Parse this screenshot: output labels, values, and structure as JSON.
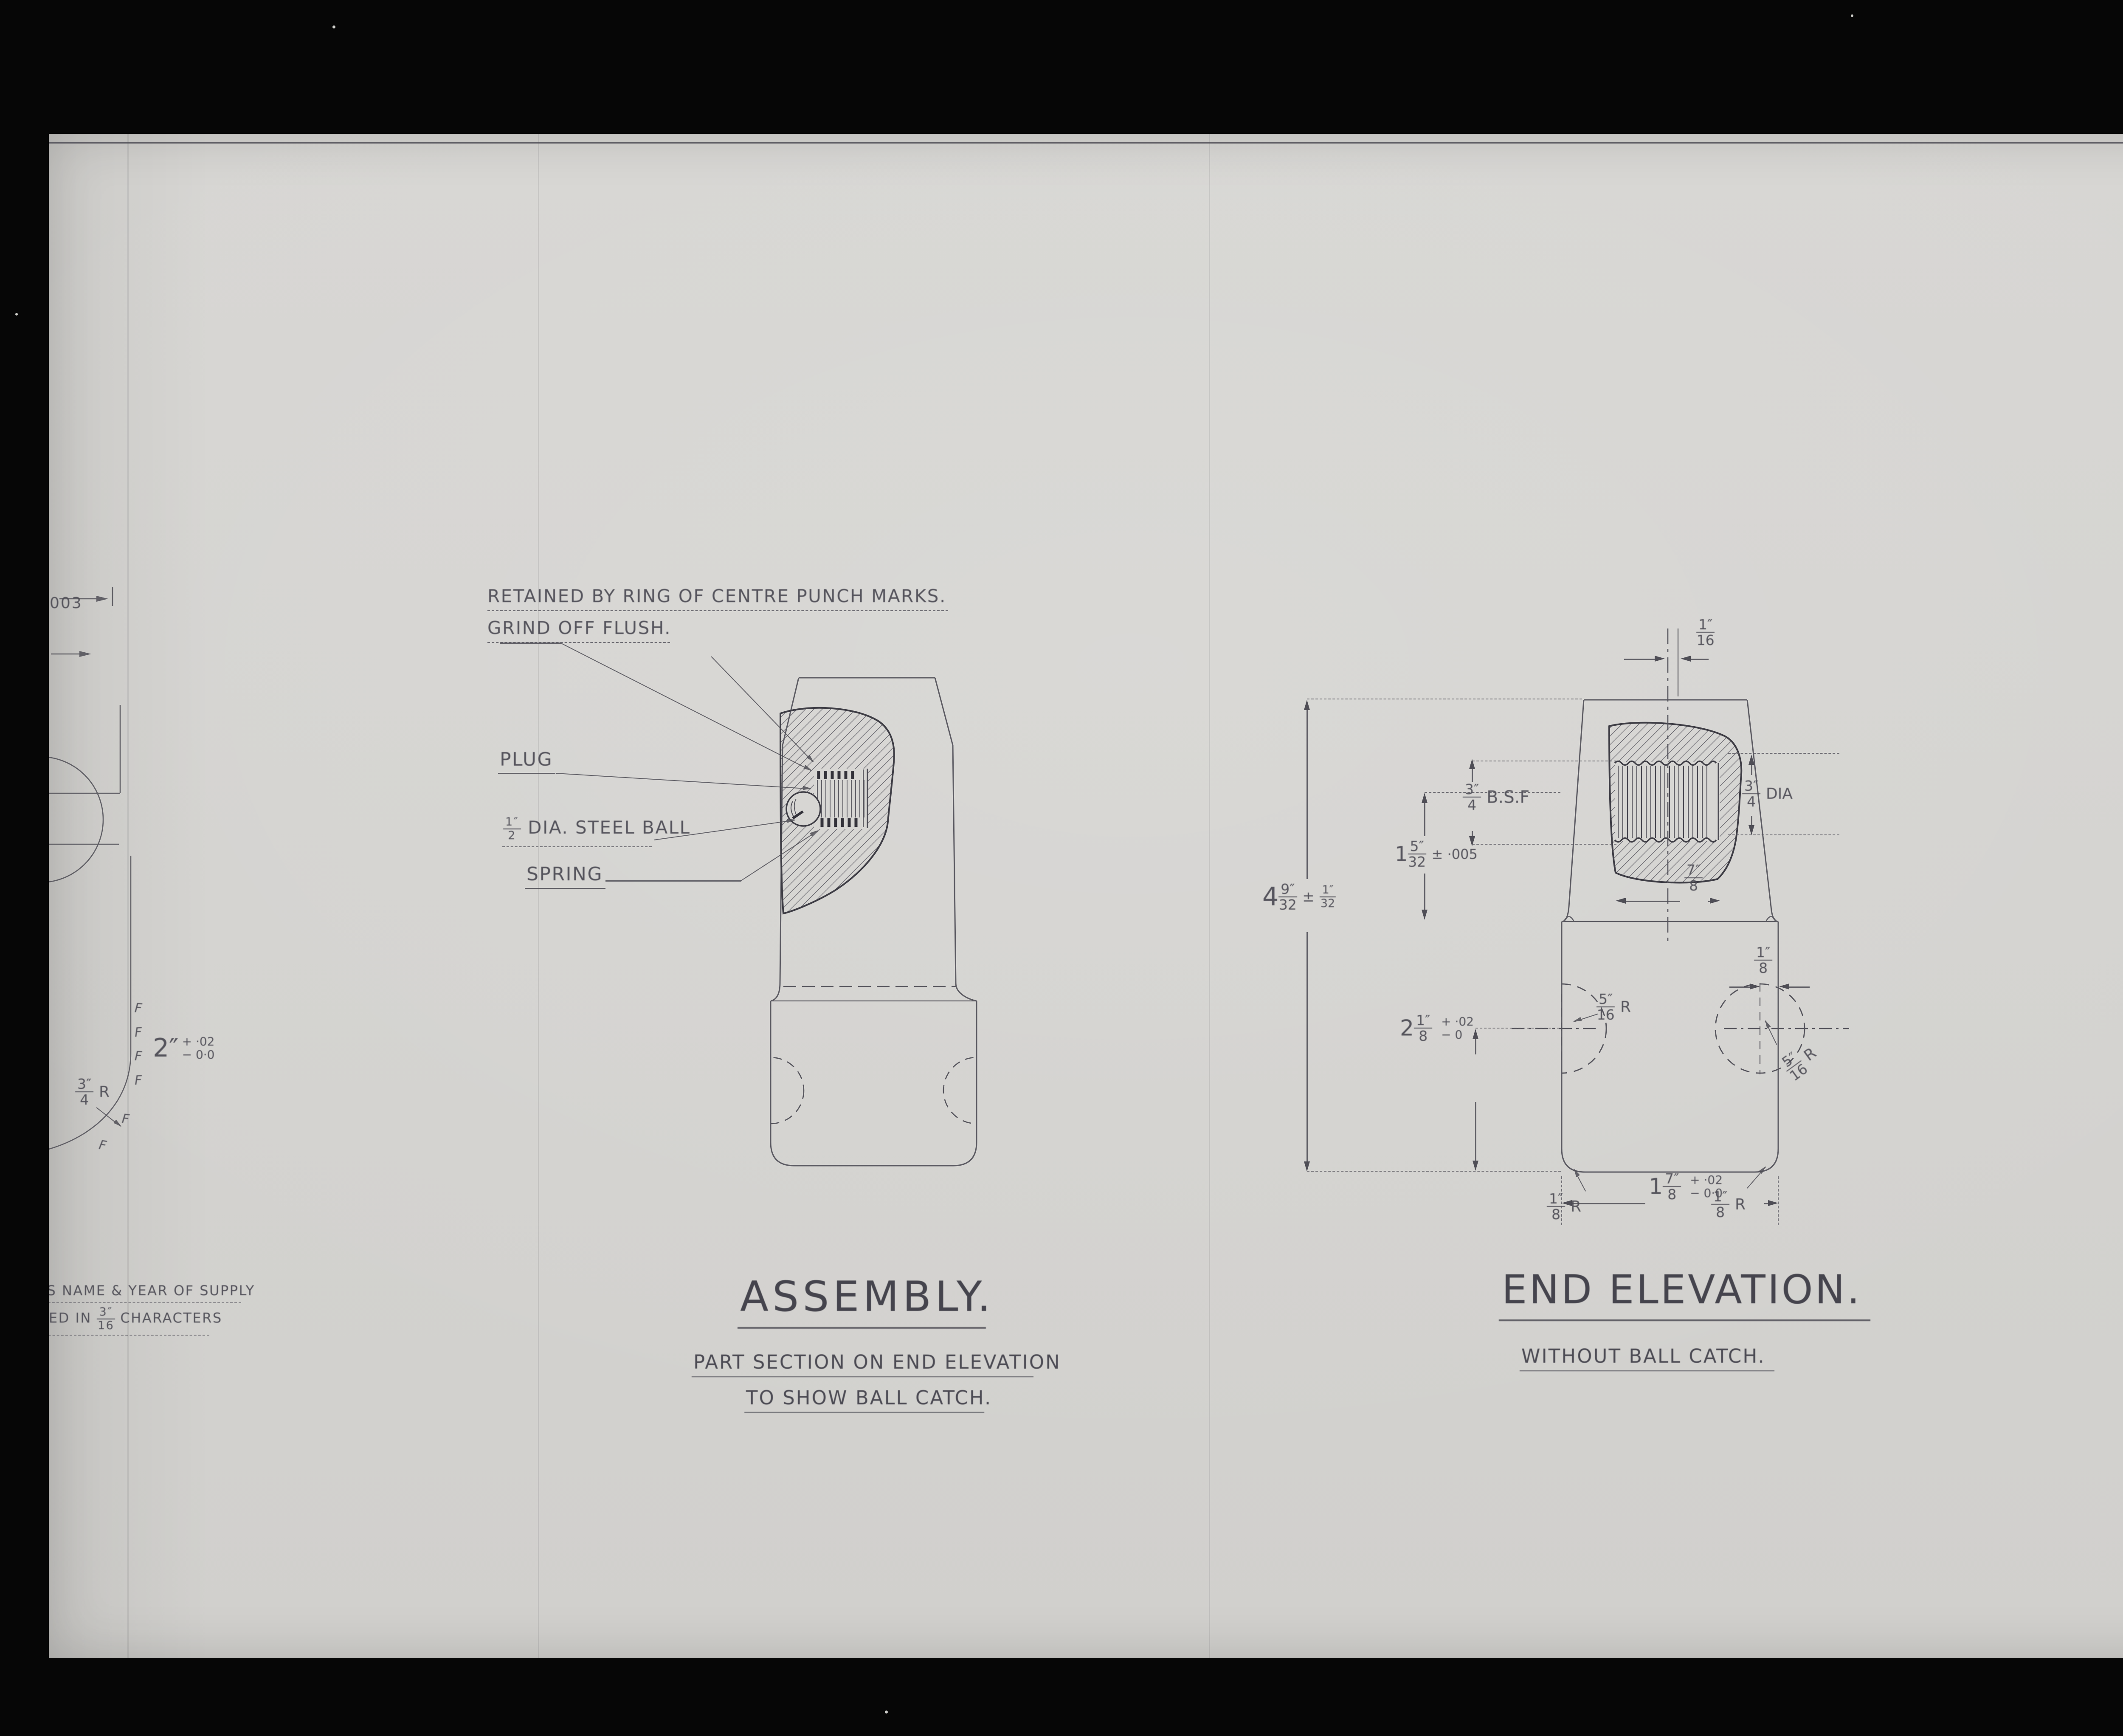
{
  "palette": {
    "paper": "#d6d5d2",
    "line": "#4f4e56",
    "stamp_ink": "#1a1a1a"
  },
  "corner_note": {
    "l1": "GIVEN A",
    "l2": "NEW. I.R.E.S Nº.",
    "l3": "OLD Nº WAS",
    "l4": "I.R.E.S/M/3940",
    "l4_sup": "c",
    "l5": "/XII/10."
  },
  "left_view": {
    "dim003": "003",
    "dim2": {
      "whole": "2″",
      "plus": "+ ·02",
      "minus": "− 0·0"
    },
    "radius": {
      "num": "3″",
      "den": "4",
      "suffix": "R"
    },
    "finish": "F",
    "note1": "ERS NAME & YEAR OF SUPPLY",
    "note2_pre": "MPED IN",
    "note2_num": "3″",
    "note2_den": "16",
    "note2_post": "CHARACTERS"
  },
  "assembly": {
    "note1": "RETAINED BY RING OF CENTRE PUNCH MARKS.",
    "note2": "GRIND OFF FLUSH.",
    "plug": "PLUG",
    "ball_num": "1″",
    "ball_den": "2",
    "ball_text": "DIA. STEEL BALL",
    "spring": "SPRING",
    "title": "ASSEMBLY.",
    "sub1": "PART SECTION ON END ELEVATION",
    "sub2": "TO SHOW BALL CATCH."
  },
  "end_elevation": {
    "title": "END ELEVATION.",
    "sub": "WITHOUT BALL CATCH.",
    "top_off": {
      "num": "1″",
      "den": "16"
    },
    "bsf": {
      "num": "3″",
      "den": "4",
      "suffix": "B.S.F"
    },
    "bore": {
      "whole": "1",
      "num": "5″",
      "den": "32",
      "tol": "± ·005"
    },
    "overall": {
      "whole": "4",
      "num": "9″",
      "den": "32",
      "pm": "±",
      "tnum": "1″",
      "tden": "32"
    },
    "depth": {
      "num": "7″",
      "den": "8"
    },
    "dia": {
      "num": "3″",
      "den": "4",
      "suffix": "DIA"
    },
    "mid": {
      "whole": "2",
      "num": "1″",
      "den": "8",
      "plus": "+ ·02",
      "minus": "− 0"
    },
    "side_r": {
      "num": "5″",
      "den": "16",
      "suffix": "R"
    },
    "hole_off": {
      "num": "1″",
      "den": "8"
    },
    "corner_r": {
      "num": "1″",
      "den": "8",
      "suffix": "R"
    },
    "width": {
      "whole": "1",
      "num": "7″",
      "den": "8",
      "plus": "+ ·02",
      "minus": "− 0·0"
    }
  },
  "stamp": {
    "l1": "REPEAT",
    "l2": "REPETITION",
    "l3_num": "2",
    "l3_text": "OF / DE"
  }
}
